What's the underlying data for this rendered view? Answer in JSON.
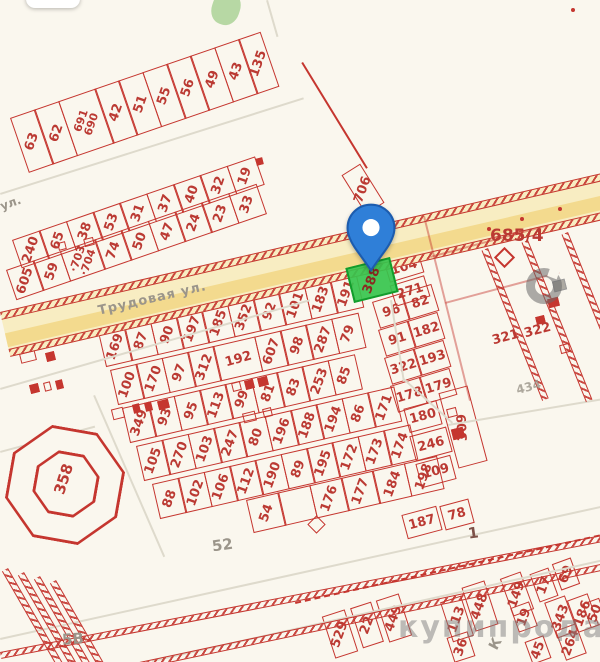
{
  "app": {
    "type": "cadastral-map-view"
  },
  "palette": {
    "background": "#faf7ee",
    "parcel_red": "#c5362f",
    "number_red": "#bb3a33",
    "road_yellow": "#f8edc2",
    "road_stripe": "#f3da8e",
    "pin_blue": "#2f7fd8",
    "plot_green": "#36c44d",
    "gray_label": "#9b958a",
    "watermark_gray": "#7d7d7d"
  },
  "map": {
    "street_main": "Трудовая ул.",
    "street_left": "ул.",
    "watermark_text": "купипродай",
    "marker": {
      "selected_plot": "388"
    },
    "labels": {
      "plot_685": "685/4",
      "octagon": "358",
      "bottom_left": "5В",
      "mid_gray": "52",
      "road_num": "1",
      "gray_434": "434",
      "p321": "321",
      "p322": "322",
      "k_letter": "К"
    }
  },
  "parcels": {
    "row_top": [
      "63",
      "62",
      [
        "691",
        "690"
      ],
      "42",
      "51",
      "55",
      "56",
      "49",
      "43",
      "135"
    ],
    "band_upper": [
      "240",
      "65",
      "38",
      "53",
      "31",
      "37",
      "40",
      "32",
      "19"
    ],
    "band_lower": [
      "605",
      "59",
      [
        "·703",
        "·704"
      ],
      "74",
      "50",
      "47",
      "24",
      "23",
      "33"
    ],
    "cell_706": "706",
    "main_rows": [
      [
        "169",
        "87",
        "90",
        "197",
        "185",
        "352",
        "92",
        "101",
        "183",
        "191"
      ],
      [
        "100",
        "170",
        "97",
        "312",
        "192",
        "607",
        "98",
        "287",
        "79"
      ],
      [
        "349",
        "93",
        "95",
        "113",
        "99",
        "81",
        "83",
        "253",
        "85"
      ],
      [
        "105",
        "270",
        "103",
        "247",
        "80",
        "196",
        "188",
        "194",
        "86",
        "171"
      ],
      [
        "88",
        "102",
        "106",
        "112",
        "190",
        "89",
        "195",
        "172",
        "173",
        "174"
      ],
      [
        "54",
        "",
        "176",
        "177",
        "184",
        "198"
      ]
    ],
    "right_rows": [
      [
        "96",
        "82"
      ],
      [
        "91",
        "182"
      ],
      [
        "322",
        "193"
      ],
      [
        "178",
        "179"
      ]
    ],
    "right_singles": [
      "104",
      "271",
      "180",
      "246",
      "109",
      "309",
      "187",
      "78"
    ],
    "bottom_right": [
      "529",
      "22",
      "449",
      "448",
      "113",
      "36",
      "149",
      "19",
      "17",
      "343",
      "264",
      "45",
      "69",
      "186",
      "50"
    ]
  }
}
